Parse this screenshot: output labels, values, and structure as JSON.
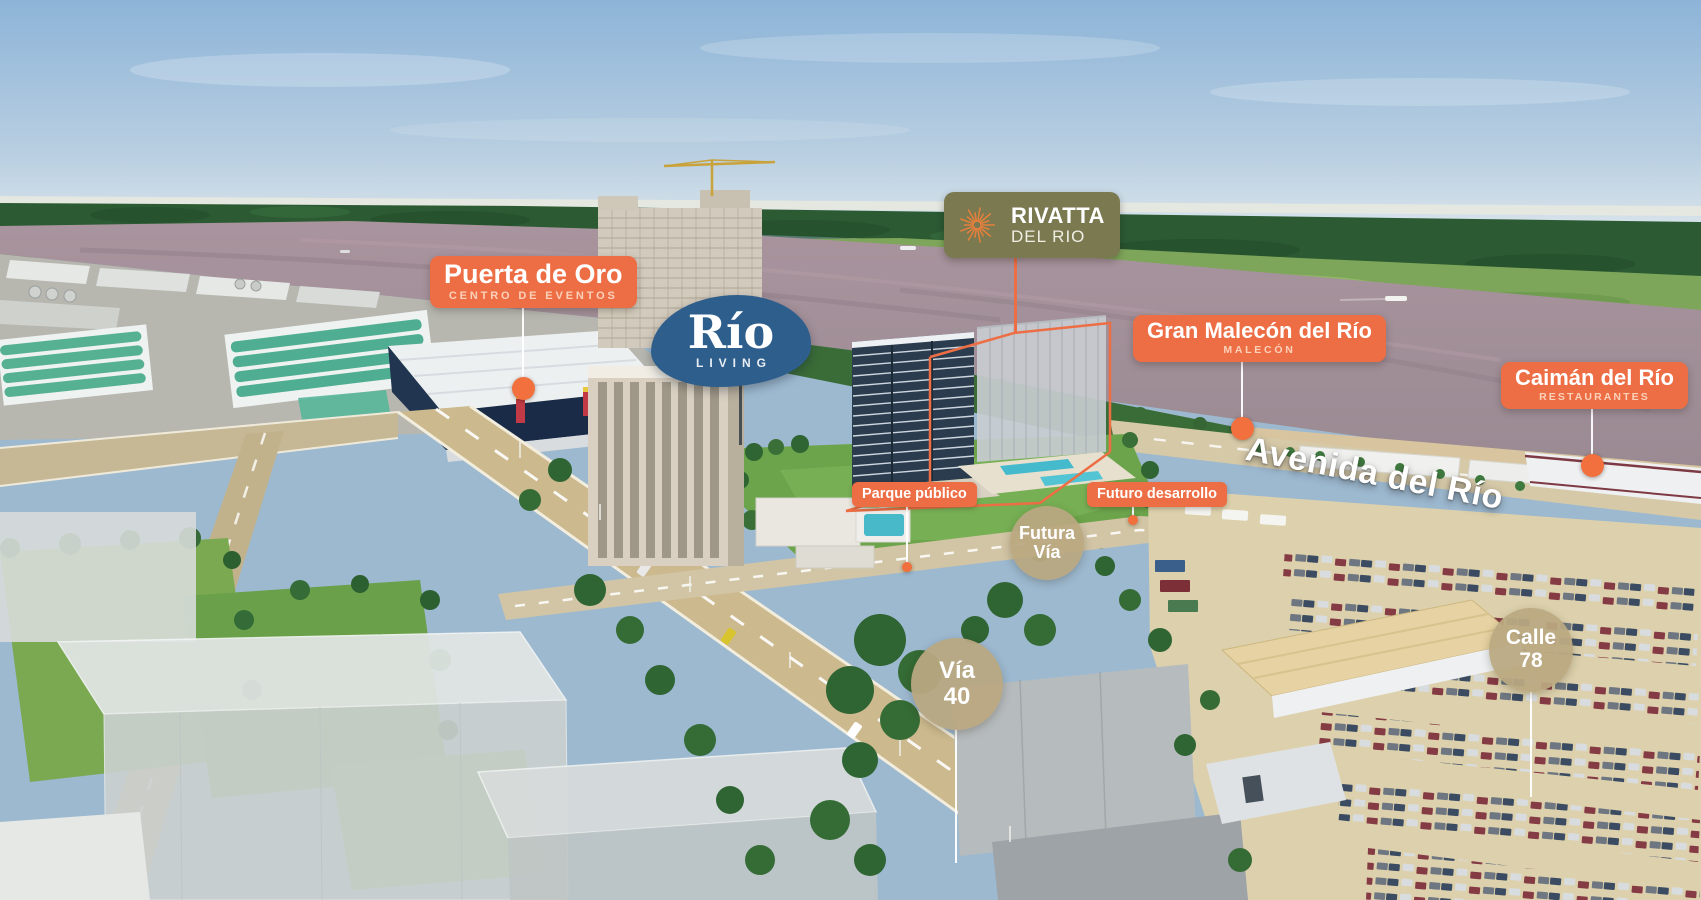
{
  "annotations": {
    "puerta_de_oro": {
      "title": "Puerta de Oro",
      "subtitle": "CENTRO DE EVENTOS"
    },
    "rio_living": {
      "title": "Río",
      "subtitle": "LIVING"
    },
    "rivatta": {
      "title": "RIVATTA",
      "subtitle": "DEL RIO"
    },
    "gran_malecon": {
      "title": "Gran Malecón del Río",
      "subtitle": "MALECÓN"
    },
    "caiman_del_rio": {
      "title": "Caimán del Río",
      "subtitle": "RESTAURANTES"
    },
    "parque_publico": {
      "label": "Parque público"
    },
    "futuro_desarrollo": {
      "label": "Futuro desarrollo"
    },
    "road_badges": {
      "futura_via": {
        "line1": "Futura",
        "line2": "Vía"
      },
      "via_40": {
        "line1": "Vía",
        "line2": "40"
      },
      "calle_78": {
        "line1": "Calle",
        "line2": "78"
      }
    },
    "avenida_del_rio": {
      "label": "Avenida del Río"
    }
  },
  "colors": {
    "label_orange": "#ED6E44",
    "marker_orange": "#F2703D",
    "olive_green": "#7A7950",
    "logo_blue": "#2E5E8C",
    "road_badge_tan": "#BAA881",
    "site_outline_orange": "#ED6E44"
  }
}
